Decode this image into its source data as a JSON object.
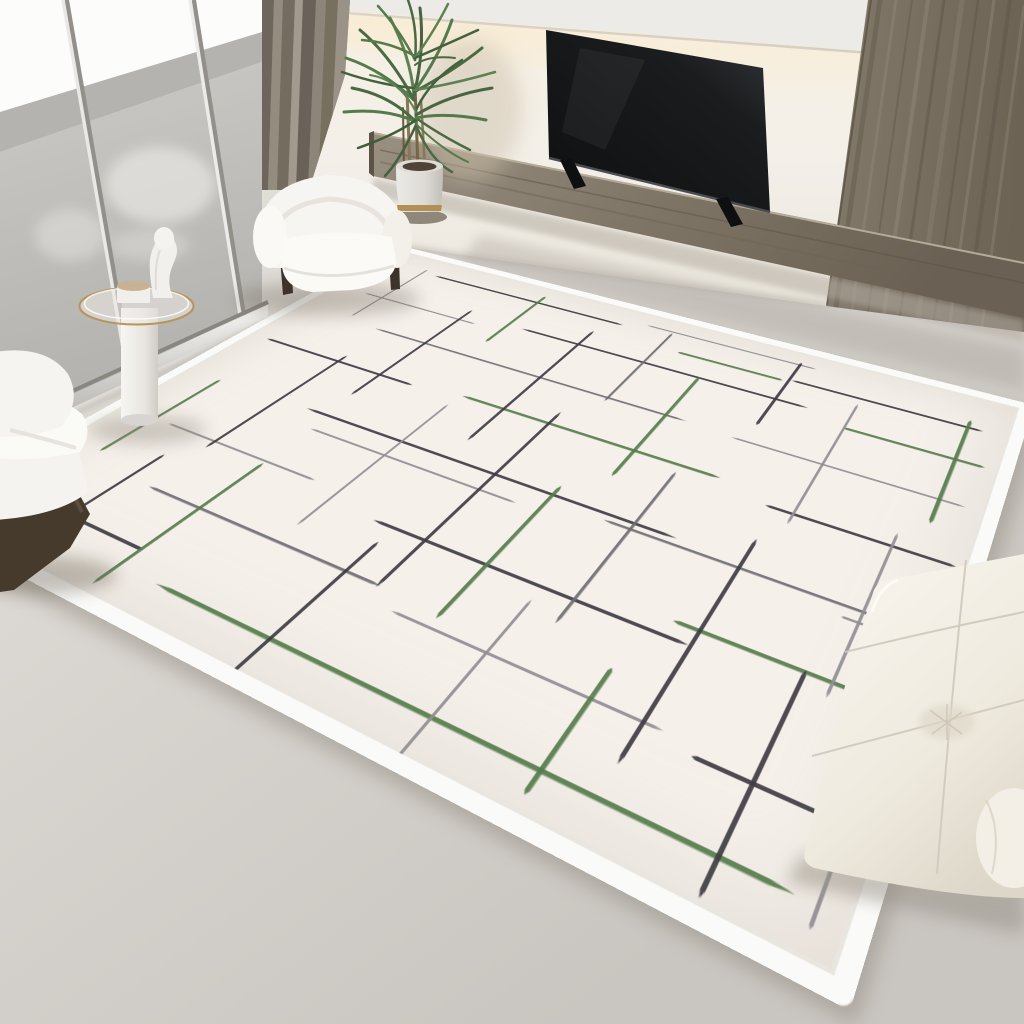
{
  "scene": {
    "kind": "interior-product-photograph",
    "subject": "modern living room with cream area rug with scattered green and grey line pattern",
    "width_px": 1024,
    "height_px": 1024,
    "objects": [
      "floor-to-ceiling-window",
      "balcony",
      "curtain",
      "potted-palm-plant",
      "floating-media-shelf",
      "television",
      "wood-wall-panel",
      "cove-light",
      "side-table",
      "sculpture",
      "boucle-armchair-top",
      "boucle-armchair-left",
      "area-rug",
      "tufted-pouf",
      "concrete-floor"
    ]
  },
  "palette": {
    "floor-mid": "#d6d2cd",
    "floor-dark": "#c7c3be",
    "floor-light": "#e6e3de",
    "wall": "#f4f0e9",
    "ceiling": "#edebe7",
    "glow": "#f9ecd2",
    "glass-sky": "#fcfcfb",
    "parapet": "#b5b3af",
    "balcony-floor": "#c3c1bd",
    "track-silver": "#eeedeb",
    "curtain": "#8a8176",
    "curtain-dark": "#6e665c",
    "curtain-light": "#9a9185",
    "panel-wood": "#7b7264",
    "shelf-wood": "#84796b",
    "tv-black": "#131416",
    "boucle": "#f7f5f1",
    "wood-base": "#463a2d",
    "gold": "#b29055",
    "leaf-green": "#557a4c",
    "rug-field": "#f5f0ea",
    "rug-border": "#fafaf8",
    "pouf": "#f4f1e9"
  },
  "rug": {
    "description": "cream low-pile rug, white banded border, abstract pattern of thin tapered perpendicular dashes",
    "local_size": {
      "w": 970,
      "h": 730
    },
    "line_colors": {
      "k": "#3e3d43",
      "d": "#6d6c72",
      "g": "#8f8e92",
      "G": "#567c4c"
    },
    "line_widths": {
      "k": 4,
      "d": 3.5,
      "g": 3,
      "G": 4.5
    },
    "pattern_lines": [
      {
        "dir": "h",
        "u": 110,
        "v": 45,
        "len": 330,
        "c": "k"
      },
      {
        "dir": "h",
        "u": 470,
        "v": 30,
        "len": 250,
        "c": "g"
      },
      {
        "dir": "h",
        "u": 700,
        "v": 70,
        "len": 240,
        "c": "k"
      },
      {
        "dir": "h",
        "u": 55,
        "v": 140,
        "len": 200,
        "c": "g"
      },
      {
        "dir": "h",
        "u": 320,
        "v": 120,
        "len": 420,
        "c": "k"
      },
      {
        "dir": "h",
        "u": 790,
        "v": 140,
        "len": 165,
        "c": "G"
      },
      {
        "dir": "h",
        "u": 140,
        "v": 215,
        "len": 480,
        "c": "d"
      },
      {
        "dir": "h",
        "u": 680,
        "v": 220,
        "len": 270,
        "c": "g"
      },
      {
        "dir": "h",
        "u": 30,
        "v": 305,
        "len": 250,
        "c": "k"
      },
      {
        "dir": "h",
        "u": 350,
        "v": 295,
        "len": 350,
        "c": "G"
      },
      {
        "dir": "h",
        "u": 760,
        "v": 315,
        "len": 200,
        "c": "k"
      },
      {
        "dir": "h",
        "u": 200,
        "v": 405,
        "len": 500,
        "c": "k"
      },
      {
        "dir": "h",
        "u": 235,
        "v": 435,
        "len": 290,
        "c": "g"
      },
      {
        "dir": "h",
        "u": 620,
        "v": 415,
        "len": 320,
        "c": "d"
      },
      {
        "dir": "h",
        "u": 80,
        "v": 505,
        "len": 230,
        "c": "g"
      },
      {
        "dir": "h",
        "u": 410,
        "v": 525,
        "len": 360,
        "c": "k"
      },
      {
        "dir": "h",
        "u": 745,
        "v": 505,
        "len": 210,
        "c": "G"
      },
      {
        "dir": "h",
        "u": 160,
        "v": 595,
        "len": 320,
        "c": "d"
      },
      {
        "dir": "h",
        "u": 510,
        "v": 615,
        "len": 280,
        "c": "g"
      },
      {
        "dir": "h",
        "u": 290,
        "v": 690,
        "len": 640,
        "c": "G"
      },
      {
        "dir": "h",
        "u": 50,
        "v": 665,
        "len": 190,
        "c": "k"
      },
      {
        "dir": "h",
        "u": 820,
        "v": 625,
        "len": 135,
        "c": "k"
      },
      {
        "dir": "h",
        "u": 540,
        "v": 75,
        "len": 150,
        "c": "G"
      },
      {
        "dir": "h",
        "u": 880,
        "v": 430,
        "len": 75,
        "c": "g"
      },
      {
        "dir": "v",
        "u": 85,
        "v": 35,
        "len": 170,
        "c": "g"
      },
      {
        "dir": "v",
        "u": 225,
        "v": 110,
        "len": 250,
        "c": "k"
      },
      {
        "dir": "v",
        "u": 295,
        "v": 25,
        "len": 150,
        "c": "G"
      },
      {
        "dir": "v",
        "u": 410,
        "v": 80,
        "len": 290,
        "c": "k"
      },
      {
        "dir": "v",
        "u": 510,
        "v": 35,
        "len": 190,
        "c": "d"
      },
      {
        "dir": "v",
        "u": 590,
        "v": 120,
        "len": 230,
        "c": "G"
      },
      {
        "dir": "v",
        "u": 695,
        "v": 25,
        "len": 160,
        "c": "k"
      },
      {
        "dir": "v",
        "u": 790,
        "v": 85,
        "len": 250,
        "c": "g"
      },
      {
        "dir": "v",
        "u": 920,
        "v": 55,
        "len": 210,
        "c": "G"
      },
      {
        "dir": "v",
        "u": 155,
        "v": 290,
        "len": 230,
        "c": "k"
      },
      {
        "dir": "v",
        "u": 55,
        "v": 410,
        "len": 170,
        "c": "G"
      },
      {
        "dir": "v",
        "u": 345,
        "v": 320,
        "len": 250,
        "c": "g"
      },
      {
        "dir": "v",
        "u": 475,
        "v": 270,
        "len": 330,
        "c": "k"
      },
      {
        "dir": "v",
        "u": 550,
        "v": 390,
        "len": 215,
        "c": "G"
      },
      {
        "dir": "v",
        "u": 650,
        "v": 310,
        "len": 250,
        "c": "d"
      },
      {
        "dir": "v",
        "u": 770,
        "v": 370,
        "len": 290,
        "c": "k"
      },
      {
        "dir": "v",
        "u": 895,
        "v": 295,
        "len": 230,
        "c": "g"
      },
      {
        "dir": "v",
        "u": 235,
        "v": 510,
        "len": 210,
        "c": "G"
      },
      {
        "dir": "v",
        "u": 125,
        "v": 550,
        "len": 170,
        "c": "k"
      },
      {
        "dir": "v",
        "u": 435,
        "v": 550,
        "len": 195,
        "c": "k"
      },
      {
        "dir": "v",
        "u": 615,
        "v": 545,
        "len": 230,
        "c": "g"
      },
      {
        "dir": "v",
        "u": 720,
        "v": 580,
        "len": 135,
        "c": "G"
      },
      {
        "dir": "v",
        "u": 870,
        "v": 505,
        "len": 220,
        "c": "k"
      },
      {
        "dir": "v",
        "u": 945,
        "v": 590,
        "len": 120,
        "c": "g"
      }
    ]
  }
}
